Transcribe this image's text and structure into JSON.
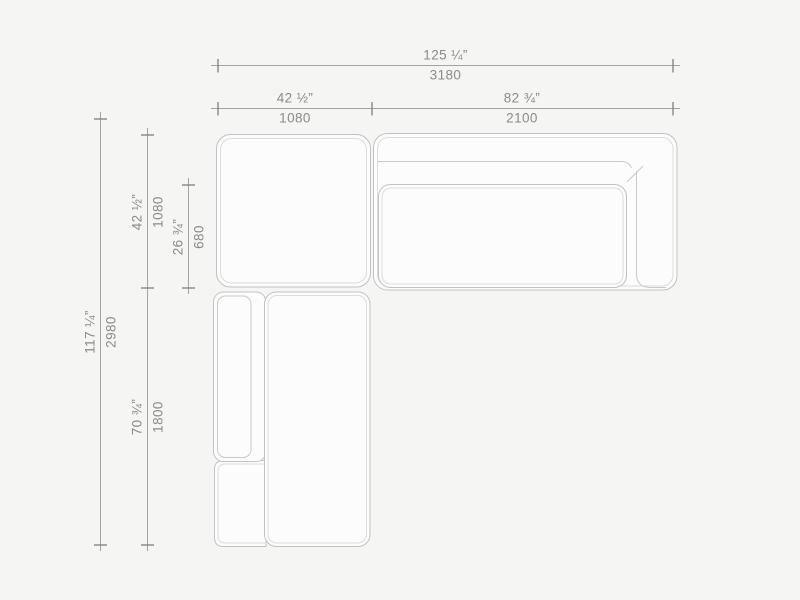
{
  "drawing": {
    "type_label": "sectional-sofa-plan-view",
    "units_primary": "inches",
    "units_secondary": "mm"
  },
  "dimensions": {
    "overall_width": {
      "inches": "125 ¼”",
      "mm": "3180"
    },
    "left_section_width": {
      "inches": "42 ½”",
      "mm": "1080"
    },
    "right_section_width": {
      "inches": "82 ¾”",
      "mm": "2100"
    },
    "overall_depth": {
      "inches": "117 ¼”",
      "mm": "2980"
    },
    "top_section_depth": {
      "inches": "42 ½”",
      "mm": "1080"
    },
    "seat_depth": {
      "inches": "26 ¾”",
      "mm": "680"
    },
    "chaise_length": {
      "inches": "70 ¾”",
      "mm": "1800"
    }
  },
  "colors": {
    "background": "#f5f5f4",
    "module_fill": "#fcfcfc",
    "module_outline": "#c2c2c2",
    "module_inner_line": "#dcdcdc",
    "dimension_line": "#a3a3a3",
    "dimension_tick": "#7f7f7f",
    "label_text": "#8a8a8a"
  }
}
